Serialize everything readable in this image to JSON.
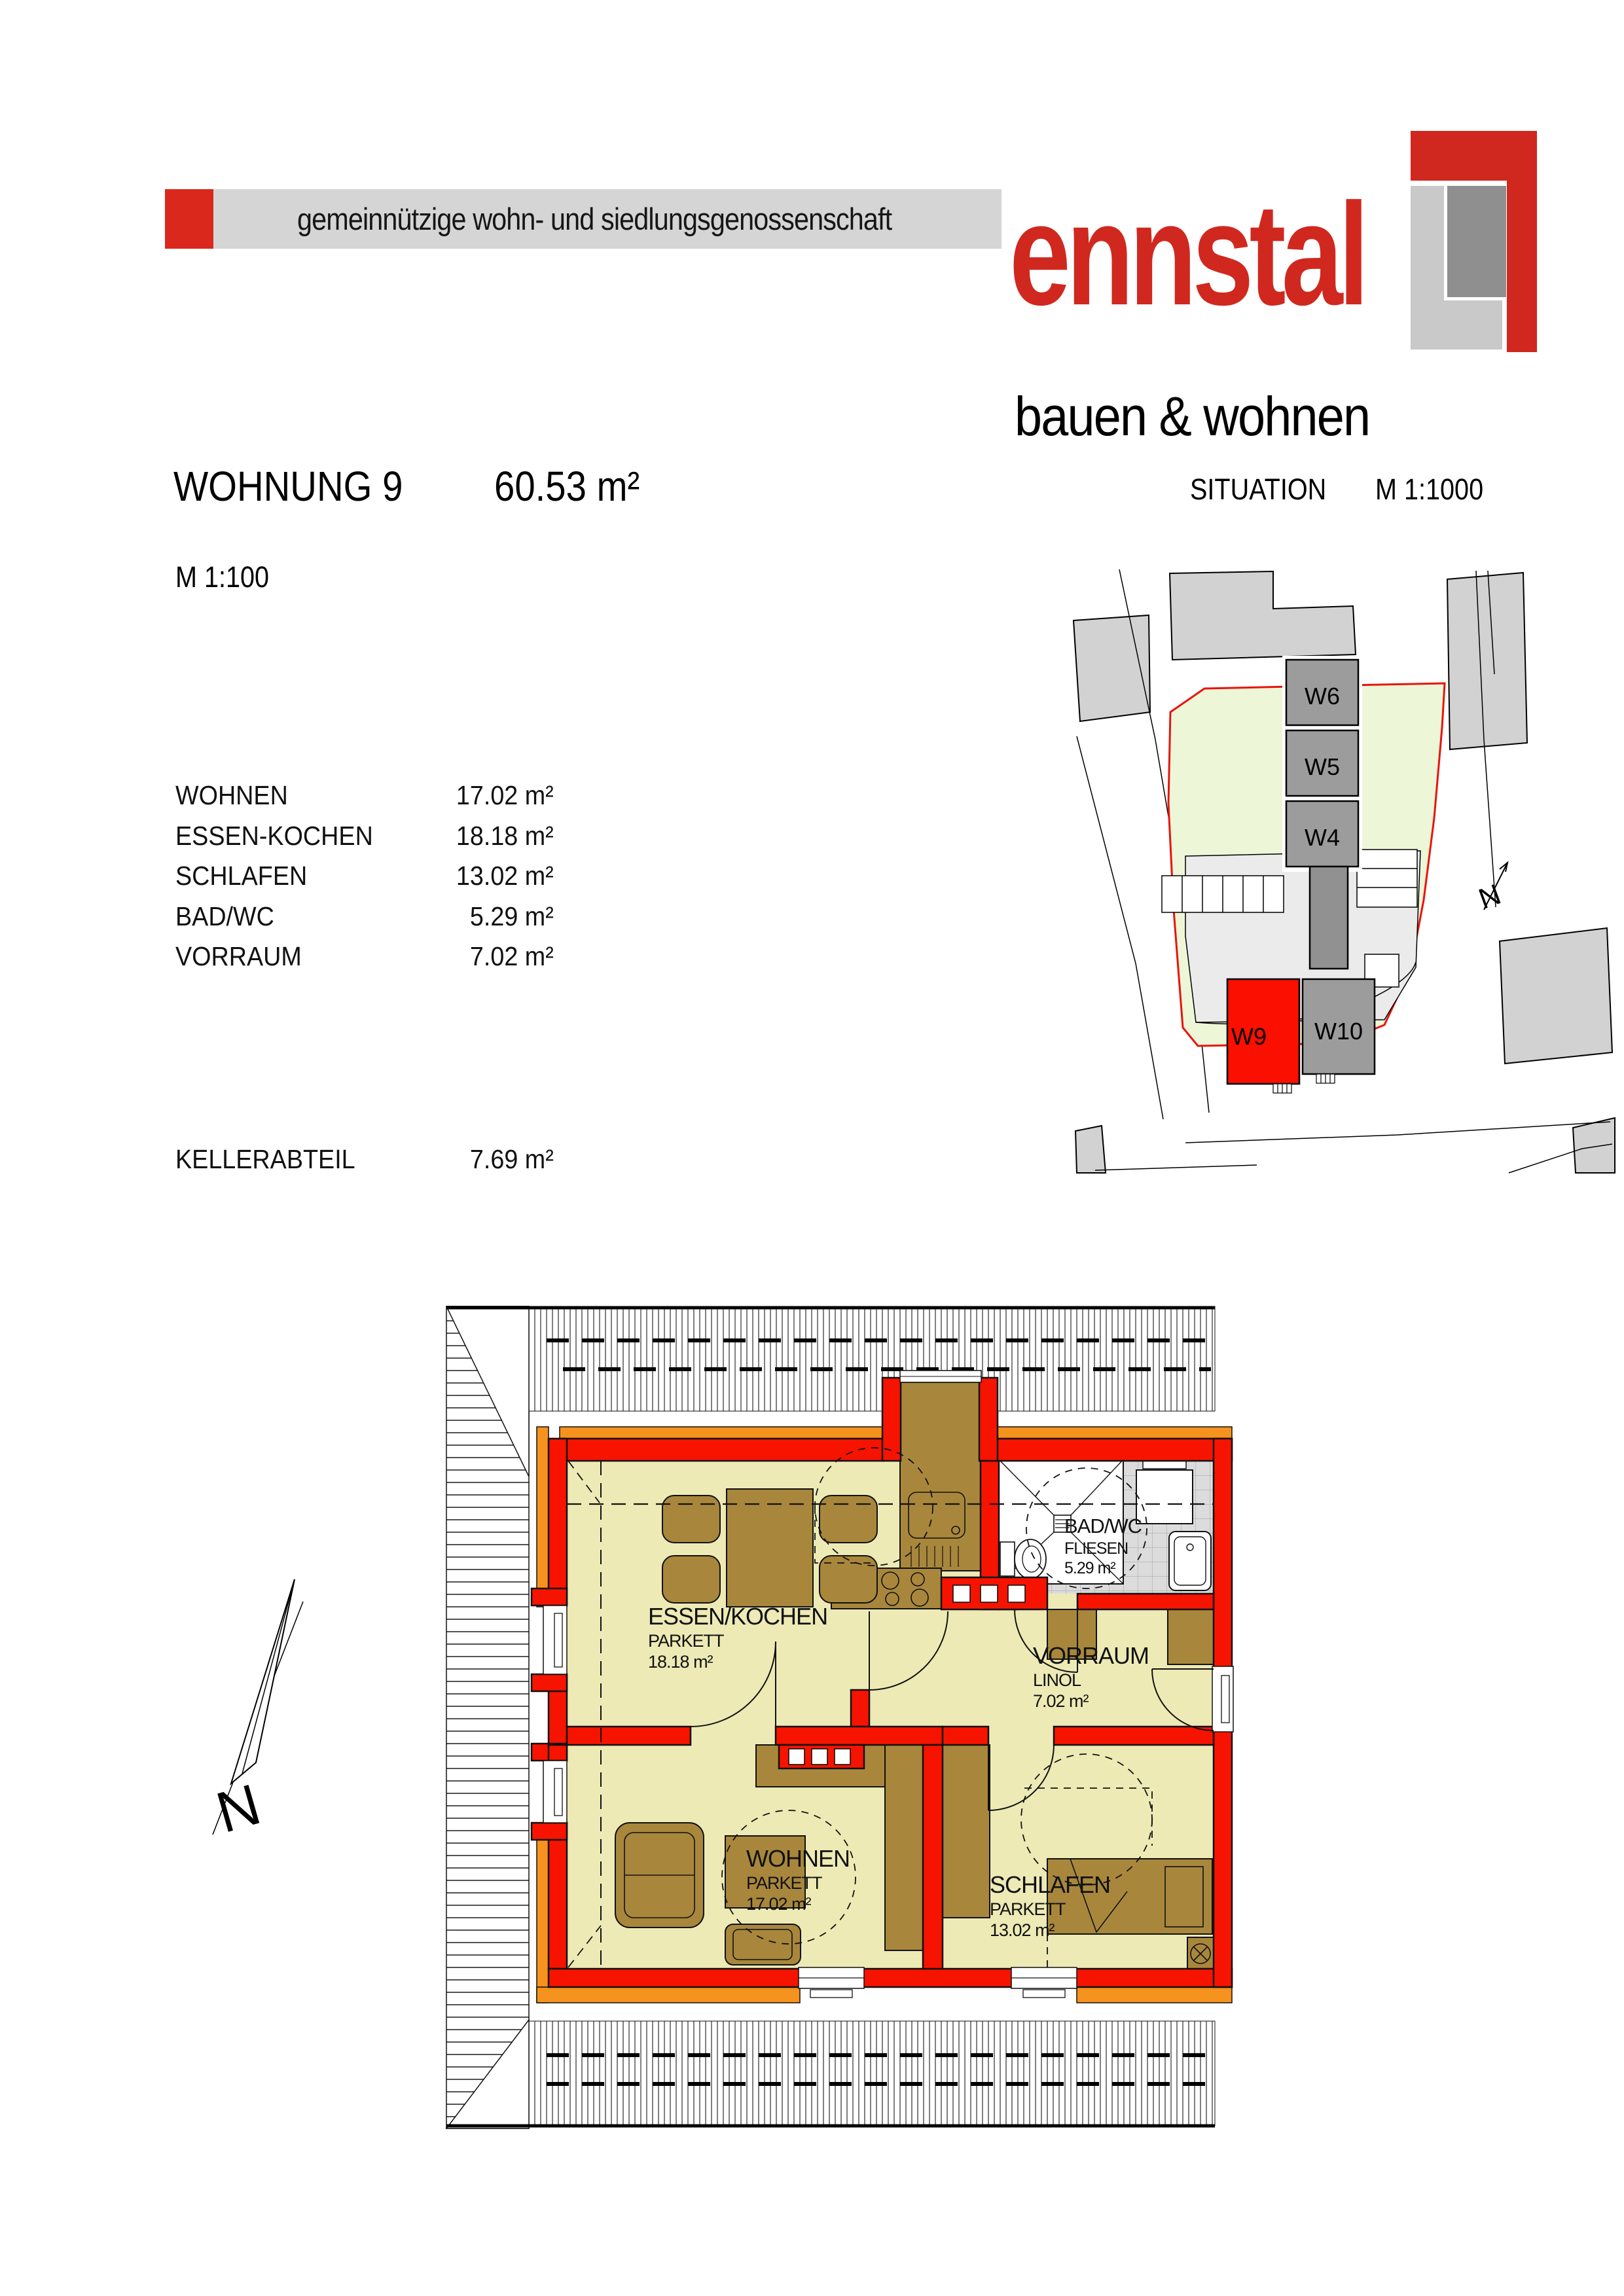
{
  "header": {
    "banner_text": "gemeinnützige wohn- und siedlungsgenossenschaft",
    "brand_name": "ennstal",
    "brand_subtitle": "bauen & wohnen",
    "colors": {
      "banner_red": "#da291c",
      "banner_gray": "#d5d5d5",
      "brand_red": "#d0281f",
      "logo_light_gray": "#c9c9c9",
      "logo_dark_gray": "#8f8f8f"
    }
  },
  "title": {
    "apartment": "WOHNUNG 9",
    "area": "60.53 m²",
    "scale": "M  1:100"
  },
  "situation": {
    "heading": "SITUATION",
    "scale": "M 1:1000",
    "north_label": "N",
    "units": [
      {
        "id": "W6"
      },
      {
        "id": "W5"
      },
      {
        "id": "W4"
      },
      {
        "id": "W9",
        "highlighted": true
      },
      {
        "id": "W10"
      }
    ],
    "colors": {
      "highlight_red": "#fa0f00",
      "building_gray": "#9c9c9c",
      "parcel_green": "#eef6d8",
      "parcel_border_red": "#e8140c",
      "neighbor_gray": "#d2d2d2",
      "plaza_gray": "#ebebeb"
    }
  },
  "room_list": {
    "rooms": [
      {
        "name": "WOHNEN",
        "area": "17.02 m²"
      },
      {
        "name": "ESSEN-KOCHEN",
        "area": "18.18 m²"
      },
      {
        "name": "SCHLAFEN",
        "area": "13.02 m²"
      },
      {
        "name": "BAD/WC",
        "area": "5.29 m²"
      },
      {
        "name": "VORRAUM",
        "area": "7.02 m²"
      }
    ],
    "cellar": {
      "name": "KELLERABTEIL",
      "area": "7.69 m²"
    }
  },
  "floorplan": {
    "north_label": "N",
    "rooms": [
      {
        "name": "ESSEN/KOCHEN",
        "floor": "PARKETT",
        "area": "18.18 m²"
      },
      {
        "name": "VORRAUM",
        "floor": "LINOL",
        "area": "7.02 m²"
      },
      {
        "name": "BAD/WC",
        "floor": "FLIESEN",
        "area": "5.29 m²"
      },
      {
        "name": "WOHNEN",
        "floor": "PARKETT",
        "area": "17.02 m²"
      },
      {
        "name": "SCHLAFEN",
        "floor": "PARKETT",
        "area": "13.02 m²"
      }
    ],
    "colors": {
      "wall_red": "#f61300",
      "accent_orange": "#f6921e",
      "floor_yellow": "#edeab5",
      "furniture_brown": "#a8873c",
      "tile_gray": "#dcdcdc"
    }
  }
}
